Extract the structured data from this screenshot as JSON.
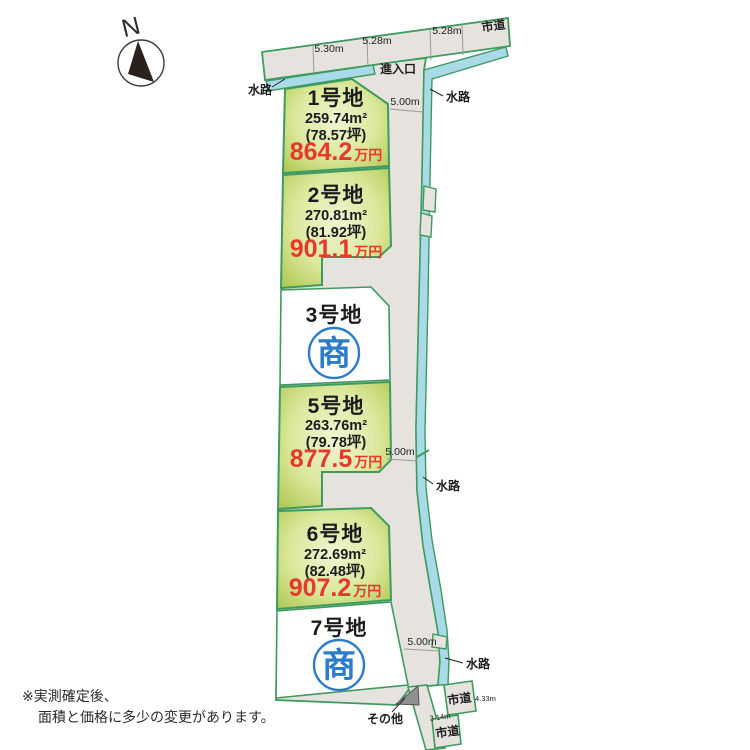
{
  "compass": {
    "label": "N"
  },
  "top_road": {
    "label": "市道",
    "measures": [
      "5.30m",
      "5.28m",
      "5.28m"
    ]
  },
  "entrance": {
    "label": "進入口"
  },
  "waterway": {
    "label": "水路"
  },
  "road": {
    "width_label": "5.00m"
  },
  "plots": [
    {
      "id": "1号地",
      "area_m2": "259.74m²",
      "area_tsubo": "(78.57坪)",
      "price": "864.2",
      "price_unit": "万円",
      "status": "for-sale"
    },
    {
      "id": "2号地",
      "area_m2": "270.81m²",
      "area_tsubo": "(81.92坪)",
      "price": "901.1",
      "price_unit": "万円",
      "status": "for-sale"
    },
    {
      "id": "3号地",
      "status": "negotiating",
      "status_mark": "商"
    },
    {
      "id": "5号地",
      "area_m2": "263.76m²",
      "area_tsubo": "(79.78坪)",
      "price": "877.5",
      "price_unit": "万円",
      "status": "for-sale"
    },
    {
      "id": "6号地",
      "area_m2": "272.69m²",
      "area_tsubo": "(82.48坪)",
      "price": "907.2",
      "price_unit": "万円",
      "status": "for-sale"
    },
    {
      "id": "7号地",
      "status": "negotiating",
      "status_mark": "商"
    }
  ],
  "bottom": {
    "city_road_label": "市道",
    "measure_right": "4.33m",
    "measure_left": "3.14m",
    "other_label": "その他"
  },
  "note": {
    "line1": "※実測確定後、",
    "line2": "面積と価格に多少の変更があります。"
  },
  "colors": {
    "border_green": "#3e9a5e",
    "plot_green_edge": "#b2ca58",
    "plot_green_center": "#f0f4d3",
    "waterway_blue": "#a8dae8",
    "road_gray": "#e6e3df",
    "price_red": "#e8382d",
    "mark_blue": "#2b7bc9",
    "other_gray": "#909090"
  }
}
